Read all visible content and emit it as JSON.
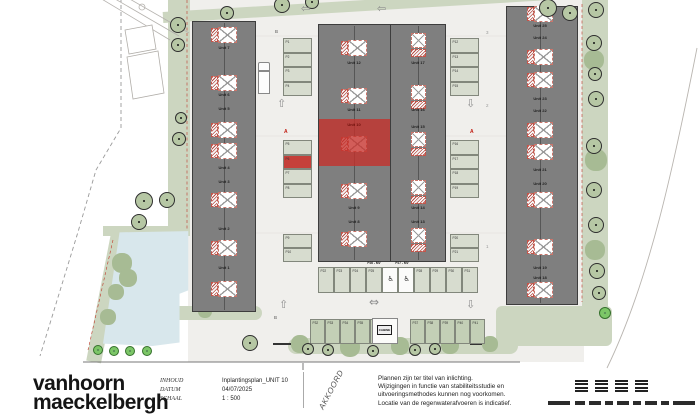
{
  "title_block": {
    "logo_line1": "vanhoorn",
    "logo_line2": "maeckelbergh",
    "fields": [
      {
        "label": "INHOUD",
        "value": "Inplantingsplan_UNIT 10"
      },
      {
        "label": "DATUM",
        "value": "04/07/2025"
      },
      {
        "label": "SCHAAL",
        "value": "1 : 500"
      }
    ],
    "stamp_text": "AKKOORD",
    "disclaimer_lines": [
      "Plannen zijn ter titel van inlichting.",
      "Wijzigingen in functie van stabiliteitsstudie en",
      "uitvoeringsmethodes kunnen nog voorkomen.",
      "Locatie van de regenwaterafvoeren is indicatief."
    ]
  },
  "plan": {
    "colors": {
      "highlight_red": "#c5403a",
      "pond_blue": "#d8e7ec",
      "tree_green": "#b6c7a4",
      "building_gray": "#7f7f7f"
    },
    "buildings": [
      {
        "name": "left-row",
        "x": 192,
        "y": 21,
        "w": 64,
        "h": 291,
        "ridges": [
          224
        ],
        "markers": [
          {
            "cx": 224,
            "cy": 35,
            "dir": "h"
          },
          {
            "cx": 224,
            "cy": 83,
            "dir": "h"
          },
          {
            "cx": 224,
            "cy": 130,
            "dir": "h"
          },
          {
            "cx": 224,
            "cy": 151,
            "dir": "h"
          },
          {
            "cx": 224,
            "cy": 200,
            "dir": "h"
          },
          {
            "cx": 224,
            "cy": 248,
            "dir": "h"
          },
          {
            "cx": 224,
            "cy": 289,
            "dir": "h"
          }
        ],
        "labels": [
          {
            "t": "Unit 7",
            "x": 224,
            "y": 47
          },
          {
            "t": "Unit 6",
            "x": 224,
            "y": 94
          },
          {
            "t": "Unit 5",
            "x": 224,
            "y": 108
          },
          {
            "t": "Unit 4",
            "x": 224,
            "y": 167
          },
          {
            "t": "Unit 3",
            "x": 224,
            "y": 181
          },
          {
            "t": "Unit 2",
            "x": 224,
            "y": 228
          },
          {
            "t": "Unit 1",
            "x": 224,
            "y": 267
          }
        ]
      },
      {
        "name": "middle-row",
        "x": 318,
        "y": 24,
        "w": 128,
        "h": 238,
        "ridges": [
          354,
          418
        ],
        "divider": 390,
        "markers": [
          {
            "cx": 354,
            "cy": 48,
            "dir": "h"
          },
          {
            "cx": 354,
            "cy": 96,
            "dir": "h"
          },
          {
            "cx": 354,
            "cy": 144,
            "dir": "h"
          },
          {
            "cx": 354,
            "cy": 191,
            "dir": "h"
          },
          {
            "cx": 354,
            "cy": 239,
            "dir": "h"
          },
          {
            "cx": 418,
            "cy": 45,
            "dir": "v"
          },
          {
            "cx": 418,
            "cy": 97,
            "dir": "v"
          },
          {
            "cx": 418,
            "cy": 144,
            "dir": "v"
          },
          {
            "cx": 418,
            "cy": 192,
            "dir": "v"
          },
          {
            "cx": 418,
            "cy": 240,
            "dir": "v"
          }
        ],
        "labels": [
          {
            "t": "Unit 12",
            "x": 354,
            "y": 62
          },
          {
            "t": "Unit 11",
            "x": 354,
            "y": 109
          },
          {
            "t": "Unit 10",
            "x": 354,
            "y": 124,
            "red": true
          },
          {
            "t": "Unit 9",
            "x": 354,
            "y": 207
          },
          {
            "t": "Unit 8",
            "x": 354,
            "y": 221
          },
          {
            "t": "Unit 17",
            "x": 418,
            "y": 62
          },
          {
            "t": "Unit 16",
            "x": 418,
            "y": 109
          },
          {
            "t": "Unit 15",
            "x": 418,
            "y": 126
          },
          {
            "t": "Unit 14",
            "x": 418,
            "y": 207
          },
          {
            "t": "Unit 13",
            "x": 418,
            "y": 221
          }
        ]
      },
      {
        "name": "right-row",
        "x": 506,
        "y": 6,
        "w": 72,
        "h": 299,
        "ridges": [
          540
        ],
        "markers": [
          {
            "cx": 540,
            "cy": 14,
            "dir": "h"
          },
          {
            "cx": 540,
            "cy": 57,
            "dir": "h"
          },
          {
            "cx": 540,
            "cy": 80,
            "dir": "h"
          },
          {
            "cx": 540,
            "cy": 130,
            "dir": "h"
          },
          {
            "cx": 540,
            "cy": 152,
            "dir": "h"
          },
          {
            "cx": 540,
            "cy": 200,
            "dir": "h"
          },
          {
            "cx": 540,
            "cy": 247,
            "dir": "h"
          },
          {
            "cx": 540,
            "cy": 290,
            "dir": "h"
          }
        ],
        "labels": [
          {
            "t": "Unit 25",
            "x": 540,
            "y": 25
          },
          {
            "t": "Unit 24",
            "x": 540,
            "y": 37
          },
          {
            "t": "Unit 23",
            "x": 540,
            "y": 98
          },
          {
            "t": "Unit 22",
            "x": 540,
            "y": 110
          },
          {
            "t": "Unit 21",
            "x": 540,
            "y": 169
          },
          {
            "t": "Unit 20",
            "x": 540,
            "y": 183
          },
          {
            "t": "Unit 19",
            "x": 540,
            "y": 267
          },
          {
            "t": "Unit 18",
            "x": 540,
            "y": 277
          }
        ]
      }
    ],
    "red_zone": {
      "x": 319,
      "y": 119,
      "w": 71,
      "h": 47
    },
    "parking": [
      {
        "x": 283,
        "y": 38,
        "dir": "v",
        "w": 29,
        "cell": 14.5,
        "spaces": [
          "P1",
          "P2",
          "P3",
          "P4"
        ]
      },
      {
        "x": 283,
        "y": 140,
        "dir": "v",
        "w": 29,
        "cell": 14.5,
        "spaces": [
          "P5",
          "P6",
          "P7",
          "P8"
        ],
        "red": [
          "P6"
        ]
      },
      {
        "x": 283,
        "y": 234,
        "dir": "v",
        "w": 29,
        "cell": 14,
        "spaces": [
          "P9",
          "P10"
        ]
      },
      {
        "x": 450,
        "y": 38,
        "dir": "v",
        "w": 29,
        "cell": 14.5,
        "spaces": [
          "P12",
          "P13",
          "P14",
          "P15"
        ]
      },
      {
        "x": 450,
        "y": 140,
        "dir": "v",
        "w": 29,
        "cell": 14.5,
        "spaces": [
          "P16",
          "P17",
          "P18",
          "P19"
        ]
      },
      {
        "x": 450,
        "y": 234,
        "dir": "v",
        "w": 29,
        "cell": 14,
        "spaces": [
          "P20",
          "P21"
        ]
      },
      {
        "x": 318,
        "y": 267,
        "dir": "h",
        "h": 26,
        "cell": 16,
        "spaces": [
          "P22",
          "P23",
          "P24",
          "P25"
        ]
      },
      {
        "x": 382,
        "y": 267,
        "dir": "h",
        "h": 26,
        "cell": 16,
        "spaces": [
          "P26",
          "P27"
        ],
        "white": true,
        "wheelchair": true,
        "hide_label": true
      },
      {
        "x": 414,
        "y": 267,
        "dir": "h",
        "h": 26,
        "cell": 16,
        "spaces": [
          "P28",
          "P29",
          "P30",
          "P31"
        ]
      },
      {
        "x": 310,
        "y": 319,
        "dir": "h",
        "h": 25,
        "cell": 15,
        "spaces": [
          "P32",
          "P33",
          "P34",
          "P35",
          "P36"
        ],
        "green": true
      },
      {
        "x": 410,
        "y": 319,
        "dir": "h",
        "h": 25,
        "cell": 15,
        "spaces": [
          "P37",
          "P38",
          "P39",
          "P40",
          "P41"
        ],
        "green": true
      }
    ],
    "handicap_labels": [
      {
        "t": "P26 - MV",
        "x": 374,
        "y": 261
      },
      {
        "t": "P27 - MV",
        "x": 402,
        "y": 261
      }
    ],
    "cabin": {
      "label": "CABINE",
      "x": 372,
      "y": 318,
      "w": 26,
      "h": 26
    },
    "truck": {
      "x": 258,
      "y": 62
    },
    "arrows": [
      {
        "g": "⇦",
        "x": 301,
        "y": 3,
        "s": 11
      },
      {
        "g": "⇦",
        "x": 377,
        "y": 3,
        "s": 11
      },
      {
        "g": "⇧",
        "x": 277,
        "y": 98,
        "s": 11
      },
      {
        "g": "⇩",
        "x": 466,
        "y": 98,
        "s": 11
      },
      {
        "g": "⇧",
        "x": 279,
        "y": 299,
        "s": 11
      },
      {
        "g": "⇩",
        "x": 466,
        "y": 299,
        "s": 11
      },
      {
        "g": "⇔",
        "x": 369,
        "y": 296,
        "s": 12
      }
    ],
    "texts": [
      {
        "t": "B",
        "x": 275,
        "y": 29,
        "s": 4.5,
        "c": "#555"
      },
      {
        "t": "B",
        "x": 274,
        "y": 315,
        "s": 4.5,
        "c": "#555"
      },
      {
        "t": "A",
        "x": 284,
        "y": 129,
        "s": 5,
        "c": "#c11a10",
        "b": 1
      },
      {
        "t": "A",
        "x": 470,
        "y": 129,
        "s": 5,
        "c": "#c11a10",
        "b": 1
      },
      {
        "t": "3",
        "x": 486,
        "y": 30,
        "s": 4.5,
        "c": "#999"
      },
      {
        "t": "2",
        "x": 486,
        "y": 103,
        "s": 4.5,
        "c": "#999"
      },
      {
        "t": "1",
        "x": 486,
        "y": 244,
        "s": 4.5,
        "c": "#999"
      }
    ],
    "trees": [
      [
        178,
        25,
        8
      ],
      [
        178,
        45,
        7
      ],
      [
        181,
        118,
        6
      ],
      [
        179,
        139,
        7
      ],
      [
        144,
        201,
        9
      ],
      [
        167,
        200,
        8
      ],
      [
        139,
        222,
        8
      ],
      [
        250,
        343,
        8
      ],
      [
        227,
        13,
        7
      ],
      [
        282,
        5,
        8
      ],
      [
        312,
        2,
        7
      ],
      [
        548,
        8,
        9
      ],
      [
        570,
        13,
        8
      ],
      [
        596,
        10,
        8
      ],
      [
        594,
        43,
        8
      ],
      [
        595,
        74,
        7
      ],
      [
        596,
        99,
        8
      ],
      [
        594,
        146,
        8
      ],
      [
        594,
        190,
        8
      ],
      [
        596,
        225,
        8
      ],
      [
        597,
        271,
        8
      ],
      [
        599,
        293,
        7
      ],
      [
        308,
        349,
        6
      ],
      [
        328,
        350,
        6
      ],
      [
        373,
        351,
        6
      ],
      [
        415,
        350,
        6
      ],
      [
        435,
        349,
        6
      ]
    ],
    "blobs": [
      [
        122,
        263,
        10
      ],
      [
        128,
        278,
        9
      ],
      [
        116,
        292,
        8
      ],
      [
        108,
        317,
        8
      ],
      [
        594,
        60,
        10
      ],
      [
        596,
        160,
        11
      ],
      [
        595,
        250,
        10
      ],
      [
        300,
        344,
        9
      ],
      [
        350,
        347,
        10
      ],
      [
        400,
        346,
        9
      ],
      [
        450,
        345,
        9
      ],
      [
        490,
        344,
        8
      ],
      [
        205,
        311,
        7
      ]
    ],
    "bushes": [
      [
        98,
        350,
        5
      ],
      [
        114,
        351,
        5
      ],
      [
        130,
        351,
        5
      ],
      [
        147,
        351,
        5
      ],
      [
        605,
        313,
        6
      ]
    ]
  }
}
